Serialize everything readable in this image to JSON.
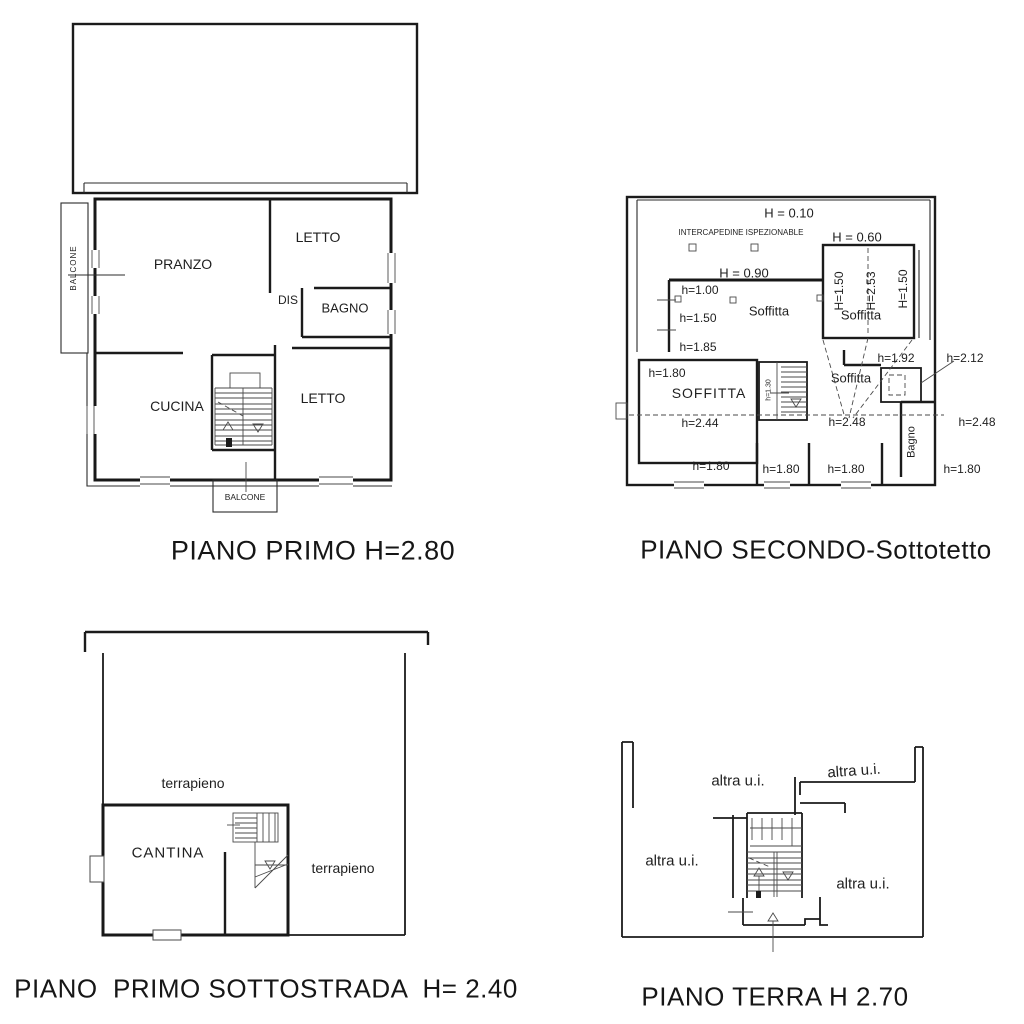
{
  "colors": {
    "line": "#1b1b1b",
    "text": "#1a1a1a",
    "background": "#ffffff"
  },
  "plans": {
    "piano_primo": {
      "title": "PIANO PRIMO H=2.80",
      "labels": {
        "balcone_left": "BALCONE",
        "pranzo": "PRANZO",
        "letto_top": "LETTO",
        "dis": "DIS",
        "bagno": "BAGNO",
        "cucina": "CUCINA",
        "letto_bottom": "LETTO",
        "balcone_bottom": "BALCONE"
      }
    },
    "piano_secondo": {
      "title": "PIANO SECONDO-Sottotetto",
      "labels": {
        "h010": "H = 0.10",
        "intercapedine": "INTERCAPEDINE ISPEZIONABLE",
        "h060": "H = 0.60",
        "h090": "H = 0.90",
        "h100": "h=1.00",
        "h150": "h=1.50",
        "h185": "h=1.85",
        "soffitta_mid": "Soffitta",
        "v_h150_left": "H=1.50",
        "v_h253": "H=2.53",
        "v_h150_right": "H=1.50",
        "soffitta_topright": "Soffitta",
        "h192": "h=1.92",
        "h212": "h=2.12",
        "h180_left": "h=1.80",
        "soffitta_left": "SOFFITTA",
        "v_h130": "h=1.30",
        "soffitta_center": "Soffitta",
        "h244": "h=2.44",
        "h248_center": "h=2.48",
        "h248_right": "h=2.48",
        "v_bagno": "Bagno",
        "h180_b1": "h=1.80",
        "h180_b2": "h=1.80",
        "h180_b3": "h=1.80",
        "h180_b4": "h=1.80"
      }
    },
    "sottostrada": {
      "title": "PIANO  PRIMO SOTTOSTRADA  H= 2.40",
      "labels": {
        "terrapieno_top": "terrapieno",
        "cantina": "CANTINA",
        "terrapieno_right": "terrapieno"
      }
    },
    "piano_terra": {
      "title": "PIANO TERRA H 2.70",
      "labels": {
        "altra_top": "altra u.i.",
        "altra_topright": "altra u.i.",
        "altra_left": "altra u.i.",
        "altra_right": "altra u.i."
      }
    }
  }
}
